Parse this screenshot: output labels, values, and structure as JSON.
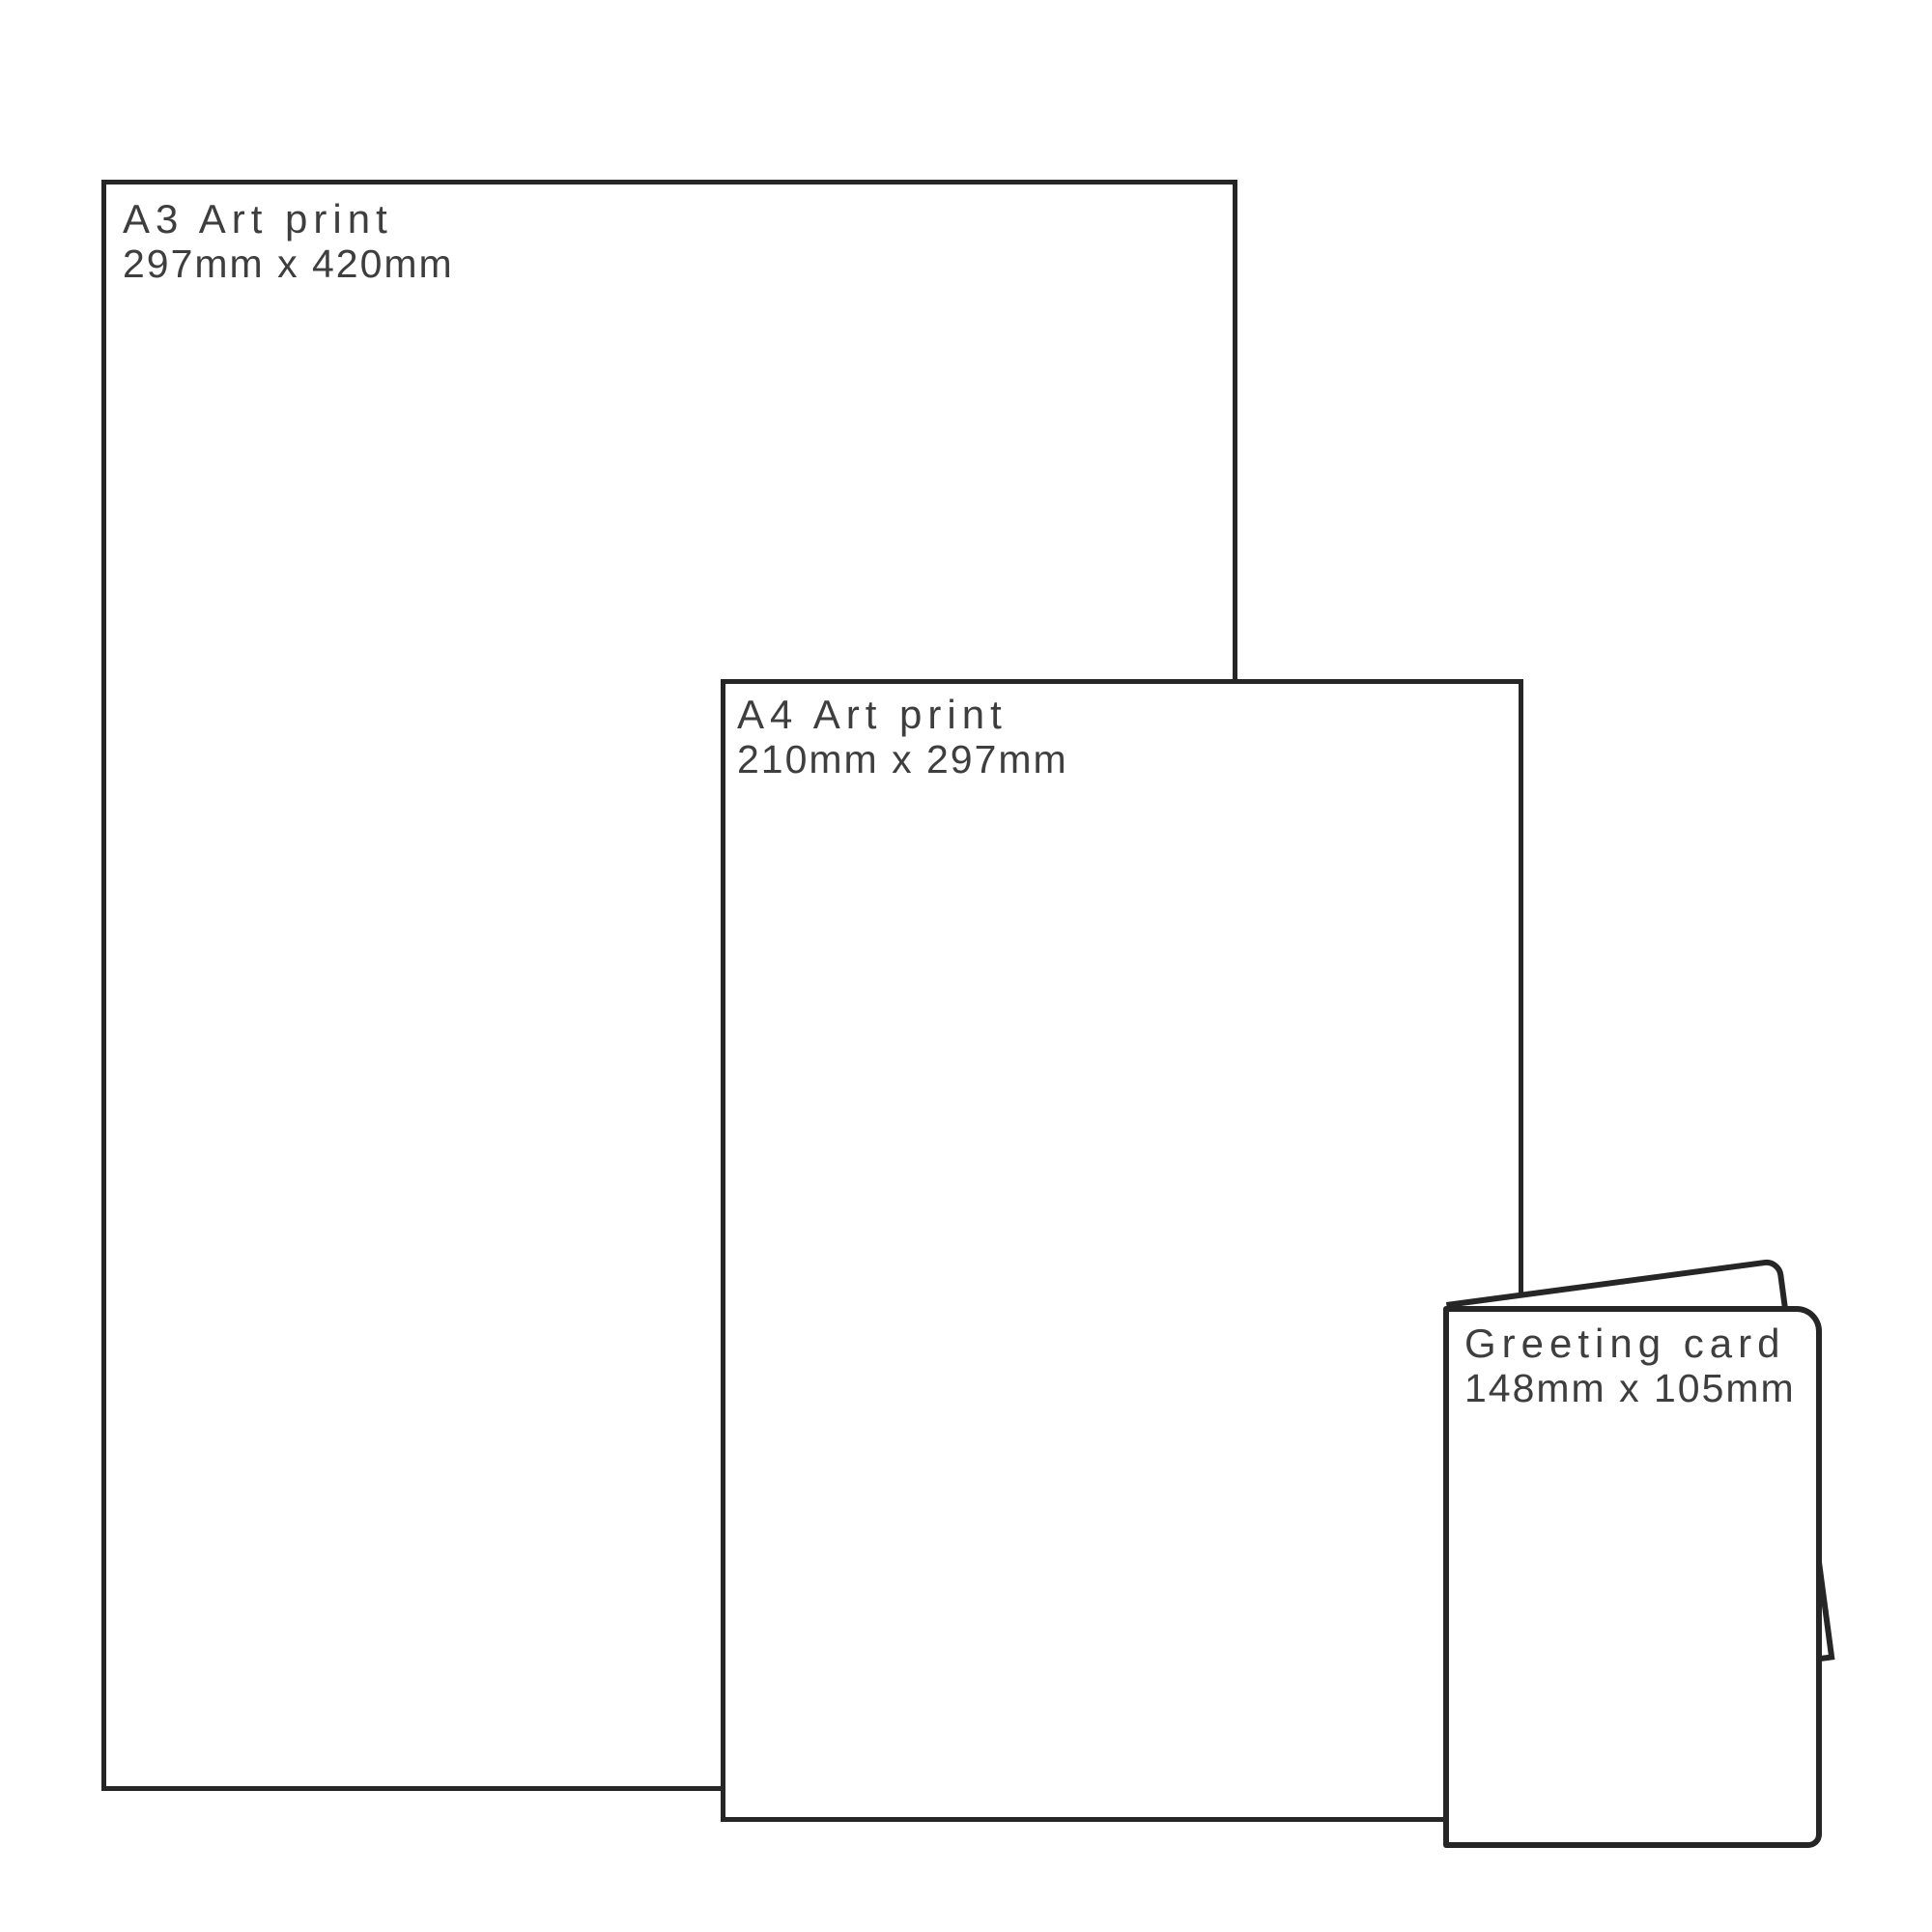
{
  "diagram": {
    "description": "Print size comparison guide",
    "colors": {
      "background": "#ffffff",
      "outline": "#262626",
      "text": "#3e3e3e"
    },
    "boxes": {
      "a3": {
        "title": "A3 Art print",
        "dims": "297mm x 420mm"
      },
      "a4": {
        "title": "A4 Art print",
        "dims": "210mm x 297mm"
      },
      "card": {
        "title": "Greeting card",
        "dims": "148mm x 105mm"
      }
    }
  }
}
